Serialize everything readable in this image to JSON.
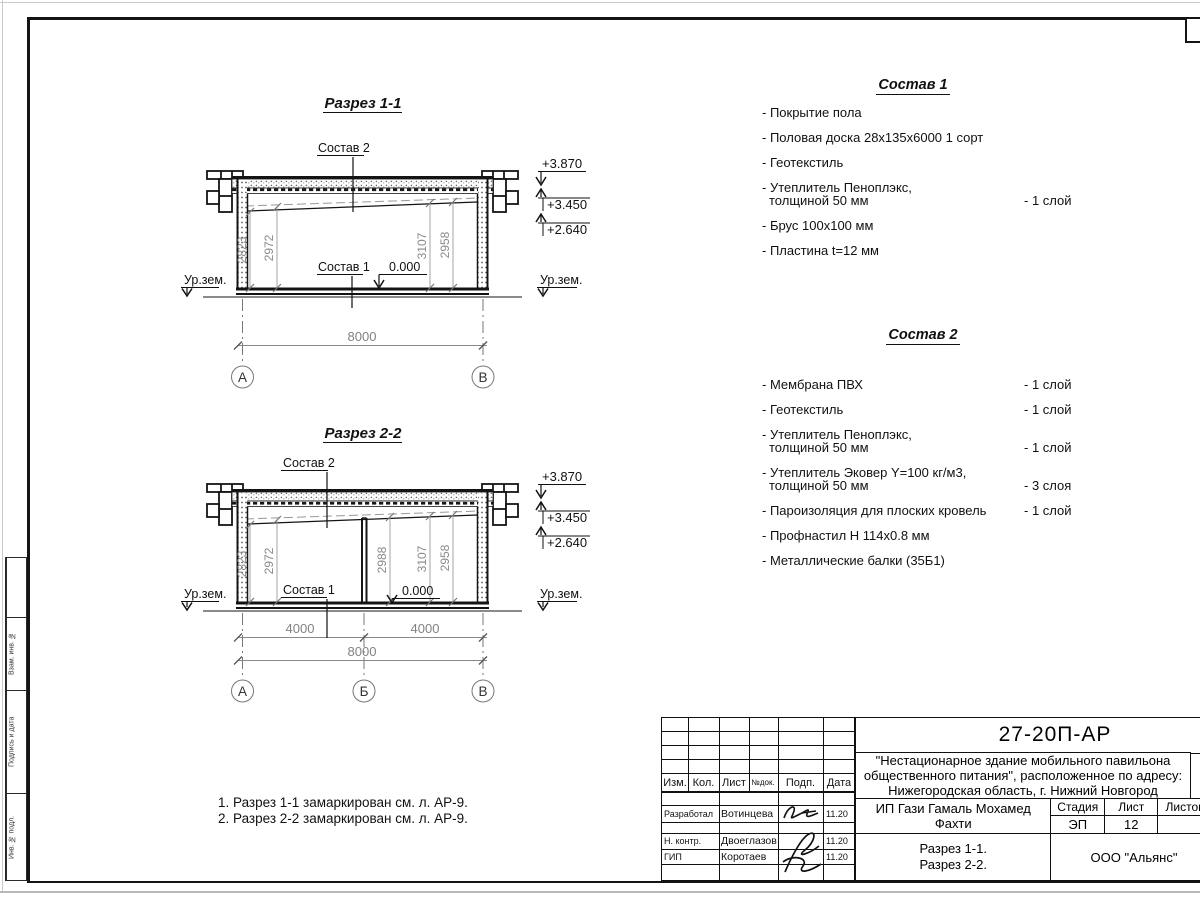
{
  "colors": {
    "line": "#141414",
    "dim": "#8a8a8a",
    "paper_edge": "#c9c9c9"
  },
  "s1": {
    "title": "Разрез 1-1",
    "label_sostav2": "Состав 2",
    "label_sostav1": "Состав 1",
    "label_zero": "0.000",
    "label_ground_left": "Ур.зем.",
    "label_ground_right": "Ур.зем.",
    "elev_top": "+3.870",
    "elev_mid": "+3.450",
    "elev_low": "+2.640",
    "dims": [
      "2823",
      "2972",
      "3107",
      "2958"
    ],
    "dim_total": "8000",
    "axes": [
      "А",
      "В"
    ]
  },
  "s2": {
    "title": "Разрез 2-2",
    "label_sostav2": "Состав 2",
    "label_sostav1": "Состав 1",
    "label_zero": "0.000",
    "label_ground_left": "Ур.зем.",
    "label_ground_right": "Ур.зем.",
    "elev_top": "+3.870",
    "elev_mid": "+3.450",
    "elev_low": "+2.640",
    "dims": [
      "2823",
      "2972",
      "2988",
      "3107",
      "2958"
    ],
    "dim_left": "4000",
    "dim_right": "4000",
    "dim_total": "8000",
    "axes": [
      "А",
      "Б",
      "В"
    ]
  },
  "sostav1": {
    "title": "Состав 1",
    "items": [
      {
        "l1": "- Покрытие пола"
      },
      {
        "l1": "- Половая доска 28х135х6000 1 сорт"
      },
      {
        "l1": "- Геотекстиль"
      },
      {
        "l1": "- Утеплитель Пеноплэкс,",
        "l2": "толщиной 50 мм",
        "qty": "- 1 слой"
      },
      {
        "l1": "- Брус 100х100 мм"
      },
      {
        "l1": "- Пластина t=12 мм"
      }
    ]
  },
  "sostav2": {
    "title": "Состав 2",
    "items": [
      {
        "l1": "- Мембрана ПВХ",
        "qty": "- 1 слой"
      },
      {
        "l1": "- Геотекстиль",
        "qty": "- 1 слой"
      },
      {
        "l1": "- Утеплитель Пеноплэкс,",
        "l2": "толщиной 50 мм",
        "qty": "- 1 слой"
      },
      {
        "l1": "- Утеплитель Эковер Y=100 кг/м3,",
        "l2": "толщиной 50 мм",
        "qty": "- 3 слоя"
      },
      {
        "l1": "- Пароизоляция для плоских кровель",
        "qty": "- 1 слой"
      },
      {
        "l1": "- Профнастил Н 114х0.8 мм"
      },
      {
        "l1": "- Металлические балки (35Б1)"
      }
    ]
  },
  "notes": {
    "line1": "1. Разрез 1-1 замаркирован см. л. АР-9.",
    "line2": "2. Разрез 2-2 замаркирован см. л. АР-9."
  },
  "titleblock": {
    "doc_number": "27-20П-АР",
    "project_line1": "\"Нестационарное здание мобильного павильона",
    "project_line2": "общественного питания\", расположенное по адресу:",
    "project_line3": "Нижегородская область, г. Нижний Новгород",
    "client": "ИП Гази Гамаль Мохамед Фахти",
    "header": {
      "izm": "Изм.",
      "kol": "Кол.",
      "list": "Лист",
      "ndok": "№док.",
      "podp": "Подп.",
      "data": "Дата"
    },
    "rows": [
      {
        "role": "Разработал",
        "name": "Вотинцева",
        "date": "11.20"
      },
      {
        "role": "Н. контр.",
        "name": "Двоеглазов",
        "date": "11.20"
      },
      {
        "role": "ГИП",
        "name": "Коротаев",
        "date": "11.20"
      }
    ],
    "stage_label": "Стадия",
    "sheet_label": "Лист",
    "sheets_label": "Листов",
    "stage_value": "ЭП",
    "sheet_value": "12",
    "sheet_title_line1": "Разрез 1-1.",
    "sheet_title_line2": "Разрез 2-2.",
    "organization": "ООО \"Альянс\""
  },
  "margin_strip": {
    "vzam": "Взам. инв. №",
    "podpis": "Подпись и дата",
    "inv": "Инв. № подл."
  }
}
